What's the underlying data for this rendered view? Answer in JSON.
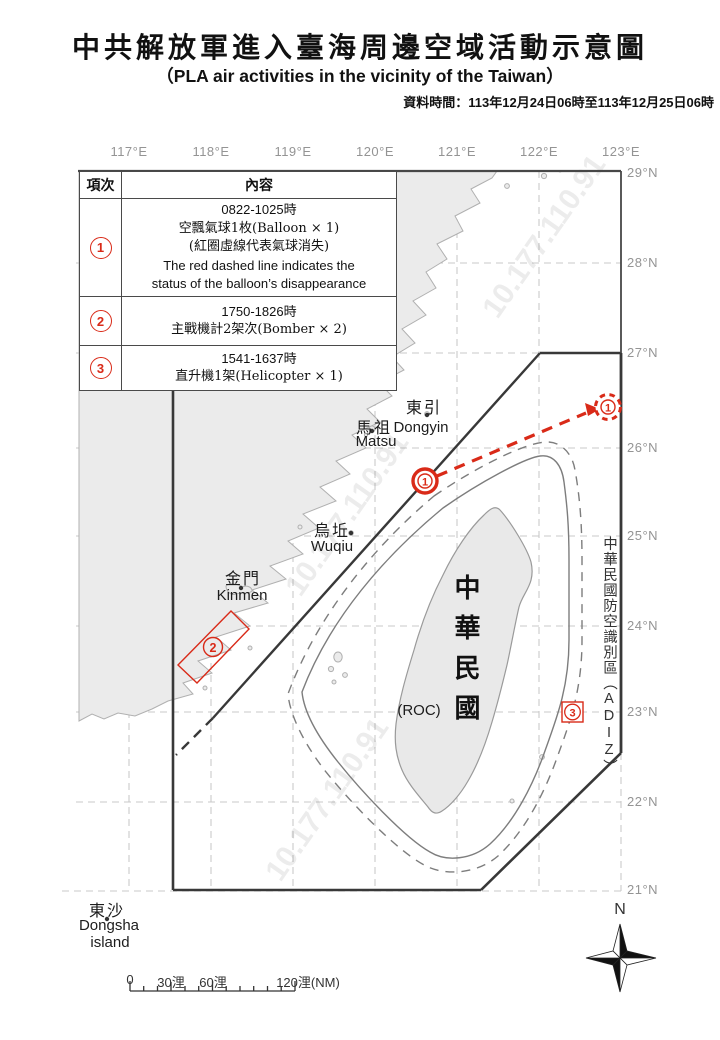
{
  "header": {
    "title_zh": "中共解放軍進入臺海周邊空域活動示意圖",
    "title_en": "（PLA air activities in the vicinity of the Taiwan）",
    "data_time": "資料時間：113年12月24日06時至113年12月25日06時"
  },
  "table": {
    "col1_header": "項次",
    "col2_header": "內容",
    "rows": [
      {
        "num": "1",
        "lines": [
          "0822-1025時",
          "空飄氣球1枚(Balloon × 1)",
          "(紅圈虛線代表氣球消失)",
          "The red dashed line indicates the",
          "status of the balloon’s disappearance"
        ]
      },
      {
        "num": "2",
        "lines": [
          "1750-1826時",
          "主戰機計2架次(Bomber × 2)"
        ]
      },
      {
        "num": "3",
        "lines": [
          "1541-1637時",
          "直升機1架(Helicopter × 1)"
        ]
      }
    ]
  },
  "map": {
    "lon_labels": [
      "117°E",
      "118°E",
      "119°E",
      "120°E",
      "121°E",
      "122°E",
      "123°E"
    ],
    "lat_labels": [
      "29°N",
      "28°N",
      "27°N",
      "26°N",
      "25°N",
      "24°N",
      "23°N",
      "22°N",
      "21°N"
    ],
    "places": {
      "dongyin_zh": "東引",
      "dongyin_en": "Dongyin",
      "matsu_zh": "馬祖",
      "matsu_en": "Matsu",
      "wuqiu_zh": "烏坵",
      "wuqiu_en": "Wuqiu",
      "kinmen_zh": "金門",
      "kinmen_en": "Kinmen",
      "dongsha_zh": "東沙",
      "dongsha_en1": "Dongsha",
      "dongsha_en2": "island",
      "roc_vertical": "中華民國",
      "roc_paren": "(ROC)",
      "adiz_label": "中華民國防空識別區（ADIZ）"
    },
    "markers": {
      "m1": "1",
      "m2": "2",
      "m3": "3"
    },
    "compass_n": "N",
    "scale_labels": [
      "0",
      "30浬",
      "60浬",
      "120浬(NM)"
    ],
    "watermark": "10.177.110.91"
  },
  "colors": {
    "activity_red": "#d92a18",
    "land_fill": "#ebebeb",
    "coast_stroke": "#b0b0b0",
    "adiz_line": "#383838",
    "grid_line": "#c9c9c9",
    "graticule_text": "#949494"
  }
}
